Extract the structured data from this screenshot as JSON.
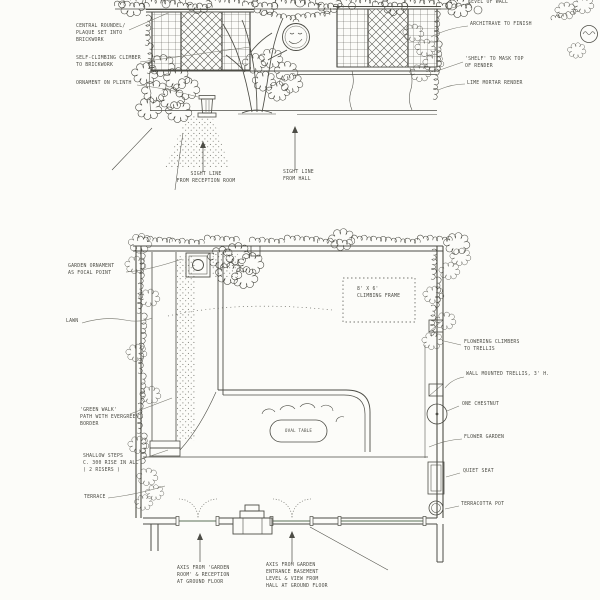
{
  "drawing": {
    "sheet_title": "garden design sheet - wall elevation and garden plan",
    "colors": {
      "ink": "#4d4d46",
      "leader": "#75756c",
      "paper": "#fcfcf9",
      "glazing": "#8f9e8d"
    },
    "elevation": {
      "labels": {
        "roundel": "CENTRAL ROUNDEL/\nPLAQUE SET INTO\nBRICKWORK",
        "climber": "SELF-CLIMBING CLIMBER\nTO BRICKWORK",
        "ornament": "ORNAMENT ON PLINTH",
        "level_of_wall": "LEVEL OF WALL",
        "architrave": "ARCHITRAVE TO FINISH",
        "shelf": "'SHELF' TO MASK TOP\nOF RENDER",
        "render": "LIME MORTAR RENDER",
        "sight_reception": "SIGHT LINE\nFROM RECEPTION ROOM",
        "sight_hall": "SIGHT LINE\nFROM HALL"
      }
    },
    "plan": {
      "labels": {
        "garden_ornament": "GARDEN ORNAMENT\nAS FOCAL POINT",
        "lawn": "LAWN",
        "green_walk": "'GREEN WALK'\nPATH WITH EVERGREEN\nBORDER",
        "shallow_steps": "SHALLOW STEPS\nC. 300 RISE IN ALL\n( 2 RISERS )",
        "terrace": "TERRACE",
        "flowering_climbers": "FLOWERING CLIMBERS\nTO TRELLIS",
        "wall_trellis": "WALL MOUNTED TRELLIS, 3' H.",
        "chestnut": "ONE CHESTNUT",
        "flower_garden": "FLOWER GARDEN",
        "quiet_seat": "QUIET SEAT",
        "terracotta_pot": "TERRACOTTA POT",
        "climbing_frame": "8' x 6'\nCLIMBING FRAME",
        "oval_table": "OVAL TABLE",
        "axis_garden_room": "AXIS FROM 'GARDEN\nROOM' & RECEPTION\nAT GROUND FLOOR",
        "axis_entrance": "AXIS FROM GARDEN\nENTRANCE BASEMENT\nLEVEL & VIEW FROM\nHALL AT GROUND FLOOR"
      }
    }
  }
}
